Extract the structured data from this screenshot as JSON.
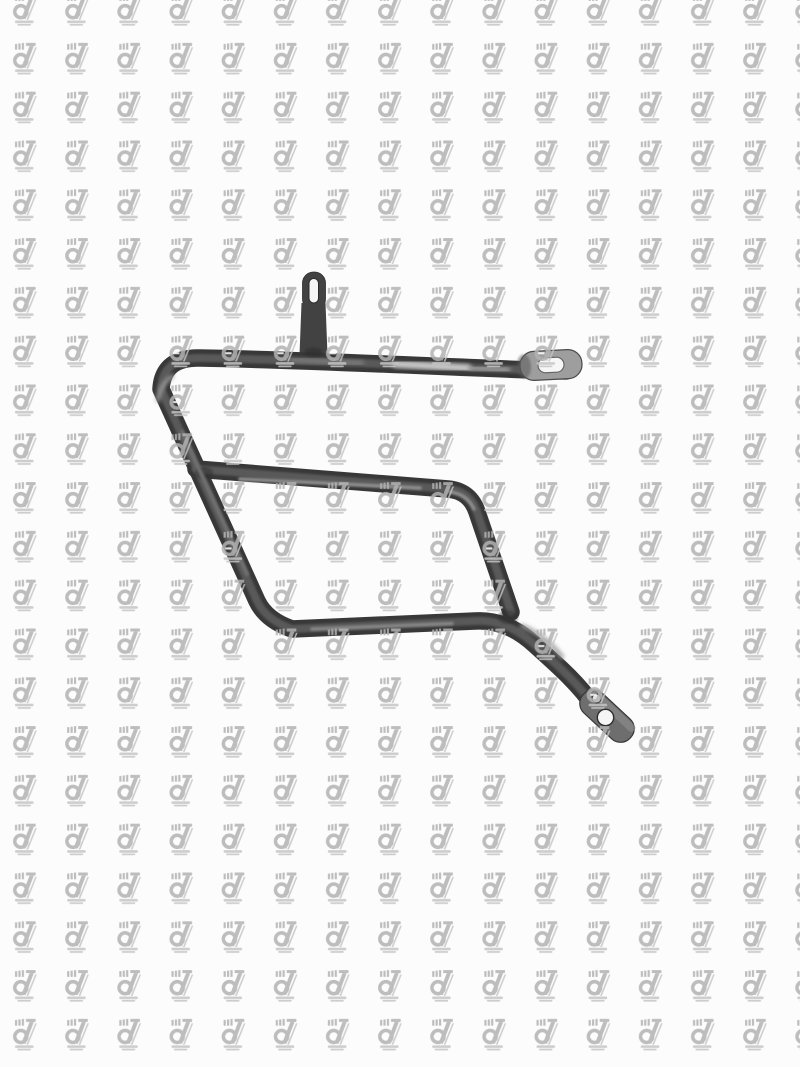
{
  "page": {
    "background_color": "#fcfcfc"
  },
  "watermark": {
    "icon": "dz-logo-watermark-icon",
    "color": "#b2b2b2",
    "accent_color": "#c5c5c5",
    "opacity": 0.85,
    "tile_width": 52.15,
    "tile_height": 48.8
  },
  "product": {
    "icon": "saddlebag-support-bracket-photo",
    "tube_color": "#383838",
    "tube_core_color": "#5d5d5d",
    "specular_color": "#cccccc",
    "right_tab_plate_color": "#9e9e9e",
    "tail_tab_plate_color": "#6e6e6e",
    "top_tab_color": "#424242",
    "hole_color": "#f6f6f6"
  }
}
